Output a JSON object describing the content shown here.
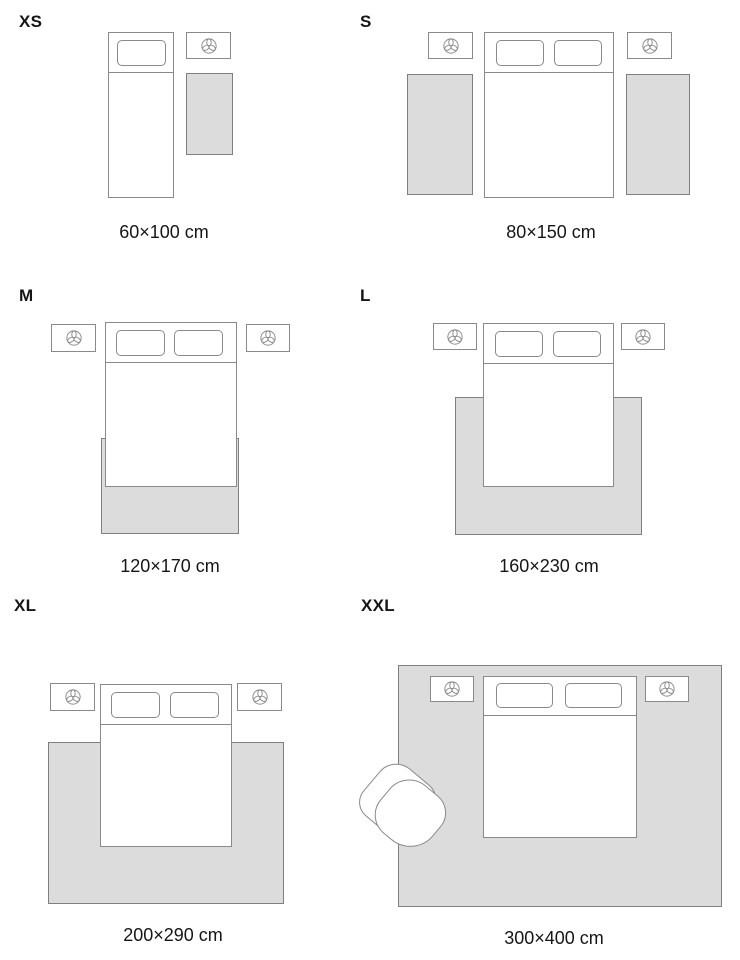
{
  "colors": {
    "bg": "#ffffff",
    "text": "#161616",
    "outline": "#8a8a8a",
    "rug_outline": "#7f7f7f",
    "rug_fill": "#dcdcdc",
    "furniture_fill": "#ffffff"
  },
  "icons": {
    "plant": "plant-icon"
  },
  "panels": [
    {
      "id": "xs",
      "label": "XS",
      "caption": "60×100 cm"
    },
    {
      "id": "s",
      "label": "S",
      "caption": "80×150 cm"
    },
    {
      "id": "m",
      "label": "M",
      "caption": "120×170 cm"
    },
    {
      "id": "l",
      "label": "L",
      "caption": "160×230 cm"
    },
    {
      "id": "xl",
      "label": "XL",
      "caption": "200×290 cm"
    },
    {
      "id": "xxl",
      "label": "XXL",
      "caption": "300×400 cm"
    }
  ]
}
